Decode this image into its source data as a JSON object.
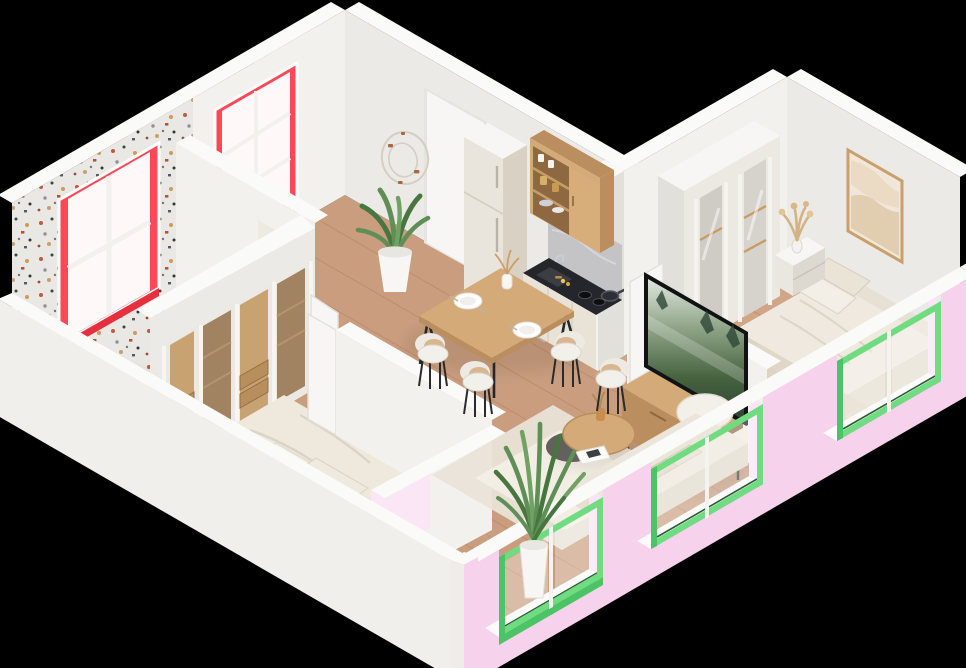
{
  "scene": {
    "title": "Isometric 3D cutaway floor plan of a one-bedroom-plus apartment",
    "subtitle": "Photoreal-style architectural render on black background",
    "projection": "isometric cutaway, walls truncated at front"
  },
  "palette": {
    "bg": "#000000",
    "wallWhite": "#f2f1ee",
    "wallWhite2": "#eceae6",
    "wallTop": "#fafaf9",
    "wallShade": "#e2e0db",
    "pink": "#f7d2ec",
    "pinkLight": "#fbe4f5",
    "green": "#70dc81",
    "greenDark": "#4cc465",
    "red": "#ff4757",
    "redDark": "#e6303f",
    "terrBase": "#e9e8e4",
    "floorWood": "#c99d7e",
    "floorLine": "#a97a55",
    "wood": "#d4aa79",
    "woodDark": "#bb8e5f",
    "woodDeep": "#8d6840",
    "counter": "#24262b",
    "marble": "#c4c4c7",
    "cream": "#e8e2d7",
    "creamDark": "#d9d1c3",
    "linen": "#efe9dd",
    "linenShade": "#ddd4c4",
    "whiteSoft": "#f7f6f4",
    "plantG": "#5f8f57",
    "plantD": "#47773f",
    "pampas": "#d3b285",
    "tvFrame": "#101214"
  },
  "rooms": [
    {
      "name": "Bathroom",
      "position": "top-left",
      "finish": "terrazzo walls and floor",
      "window_frames": "red",
      "items": [
        "bathtub",
        "glass shower screen",
        "wooden bath mat",
        "2x2-pane window"
      ]
    },
    {
      "name": "Kitchen & dining",
      "position": "top-center",
      "items": [
        "fridge",
        "open wooden shelf cabinet",
        "black countertop with sink and hob",
        "pan",
        "dining table",
        "4 white chairs",
        "entry door",
        "wire wall clock",
        "potted plant"
      ]
    },
    {
      "name": "Living room",
      "position": "center",
      "items": [
        "beige sofa",
        "round two-tone coffee table",
        "magazine",
        "area rug",
        "TV on wooden media console",
        "palm plant in window bay"
      ]
    },
    {
      "name": "Bedroom 1",
      "position": "bottom-left",
      "items": [
        "double bed with rumpled duvet",
        "sliding glass-door wardrobe",
        "open door"
      ]
    },
    {
      "name": "Bedroom 2",
      "position": "right",
      "items": [
        "double bed",
        "glass-door wardrobe",
        "nightstand with pampas vase",
        "framed artwork"
      ]
    }
  ],
  "exterior": {
    "back_walls": "white, full height",
    "front_walls": "pink cutaway with green window frames",
    "green_windows": 3,
    "red_windows": 2,
    "floor_slab_edges": [
      "white (front-left)",
      "pink (front-right)"
    ]
  }
}
